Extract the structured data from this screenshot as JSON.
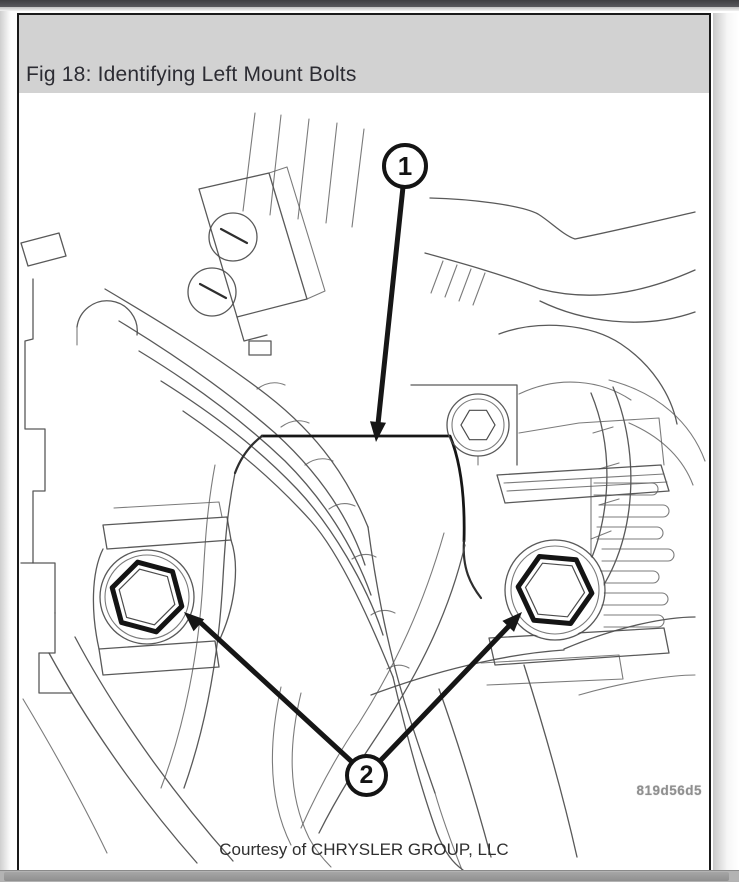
{
  "figure": {
    "title": "Fig 18: Identifying Left Mount Bolts",
    "watermark": "819d56d5",
    "credit": "Courtesy of CHRYSLER GROUP, LLC",
    "callouts": [
      {
        "number": "1",
        "target": "left mount"
      },
      {
        "number": "2",
        "target": "left mount bolts"
      }
    ],
    "colors": {
      "header_bg": "#d2d2d2",
      "frame_border": "#1a1a1a",
      "sketch_line": "#4b4b4b",
      "bold_line": "#161616",
      "watermark_text": "#8f8f8f",
      "scrollbar": "#9c9c9c"
    }
  }
}
